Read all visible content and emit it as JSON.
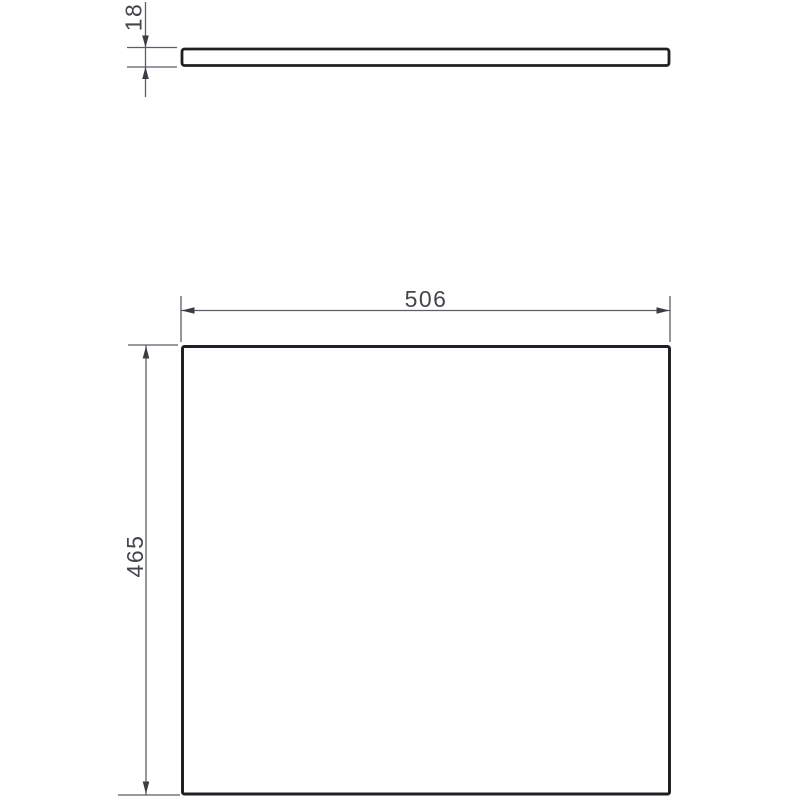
{
  "drawing": {
    "type": "technical-dimension-drawing",
    "background": "#ffffff",
    "views": {
      "top": {
        "description": "panel edge profile (thin bar)",
        "thickness_label": "18"
      },
      "front": {
        "description": "panel face (large rectangle)",
        "width_label": "506",
        "height_label": "465"
      }
    },
    "colors": {
      "outline": "#202024",
      "dim_line": "#5d5d63",
      "arrow": "#3c3c42",
      "text": "#45454b",
      "fill": "#ffffff"
    }
  }
}
